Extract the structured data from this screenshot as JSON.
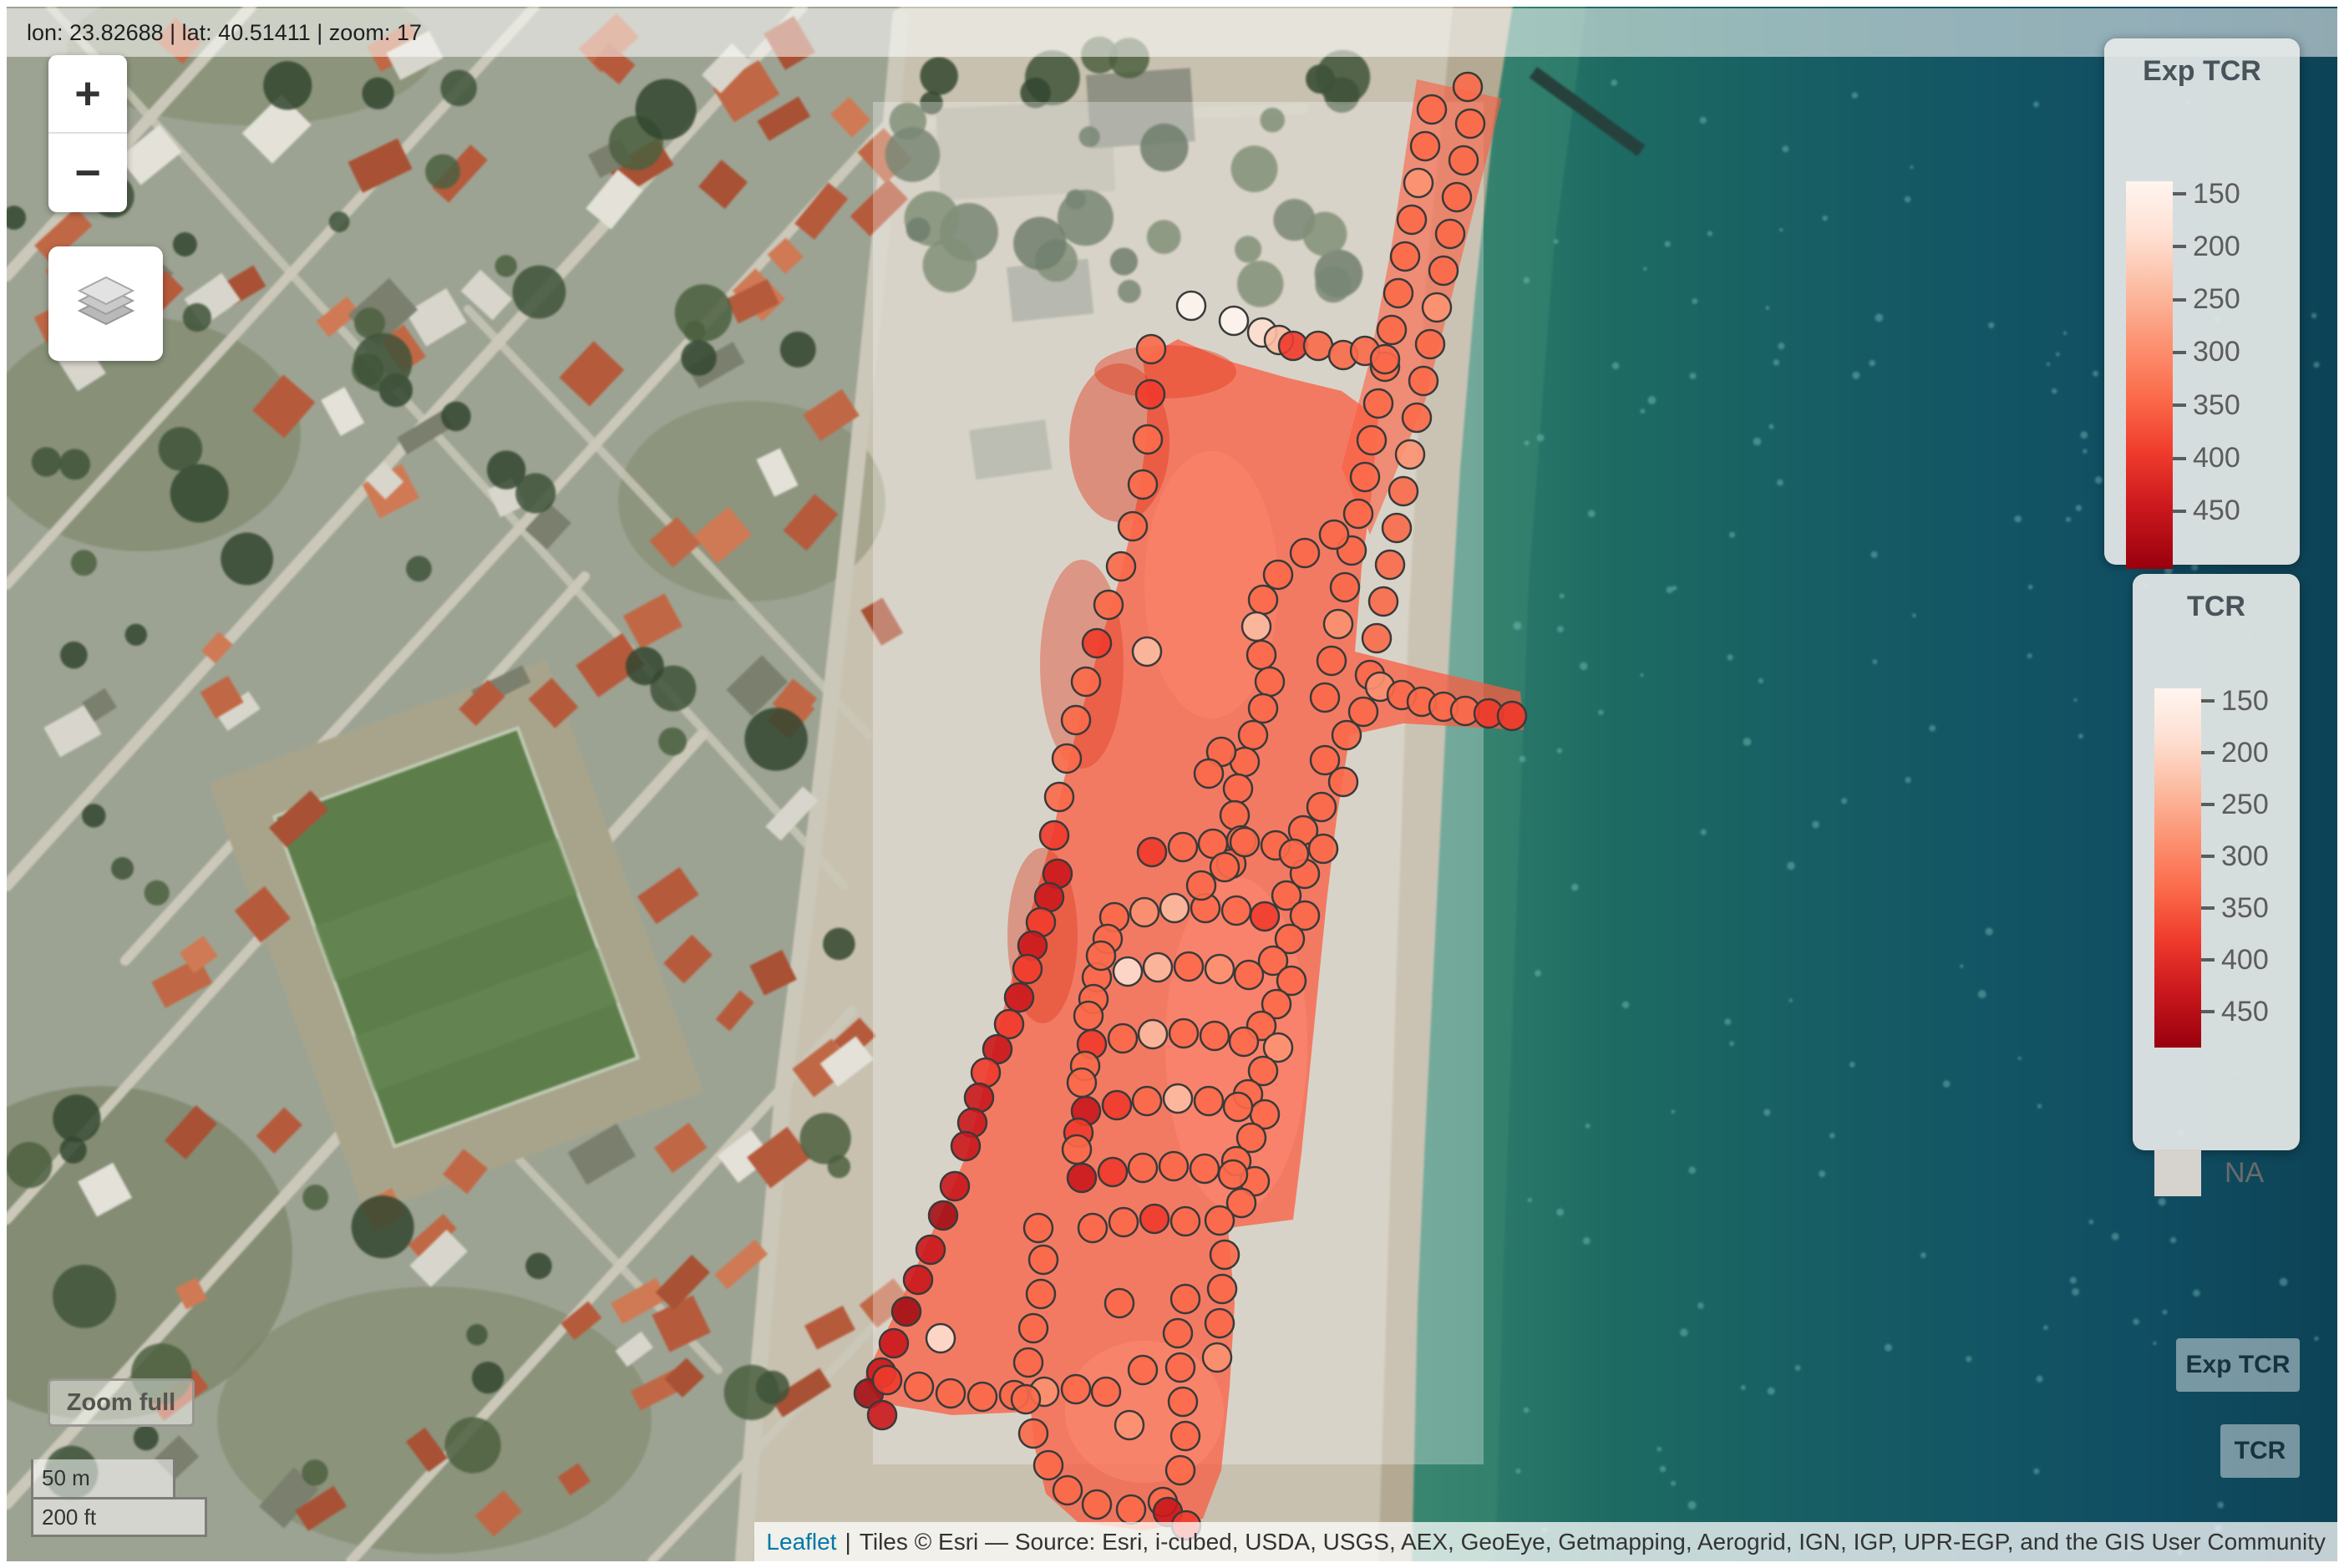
{
  "top_bar": {
    "text": "lon: 23.82688 | lat: 40.51411 | zoom: 17"
  },
  "controls": {
    "zoom_in": "+",
    "zoom_out": "−",
    "zoom_full": "Zoom full"
  },
  "scale_bar": {
    "metric": "50 m",
    "imperial": "200 ft"
  },
  "legends": [
    {
      "id": "exp-tcr",
      "title": "Exp TCR",
      "ticks": [
        "150",
        "200",
        "250",
        "300",
        "350",
        "400",
        "450"
      ]
    },
    {
      "id": "tcr",
      "title": "TCR",
      "ticks": [
        "150",
        "200",
        "250",
        "300",
        "350",
        "400",
        "450"
      ],
      "na_label": "NA"
    }
  ],
  "layer_buttons": [
    {
      "label": "Exp TCR"
    },
    {
      "label": "TCR"
    }
  ],
  "attribution": {
    "leaflet": "Leaflet",
    "separator": "|",
    "tiles": "Tiles © Esri — Source: Esri, i-cubed, USDA, USGS, AEX, GeoEye, Getmapping, Aerogrid, IGN, IGP, UPR-EGP, and the GIS User Community"
  },
  "map": {
    "marker_radius": 17,
    "palette": [
      "#FFF5F0",
      "#FEE0D2",
      "#FCBBA1",
      "#FC9272",
      "#FB6A4A",
      "#EF3B2C",
      "#CB181D",
      "#A50F15",
      "#99000D"
    ],
    "markers": [
      [
        1757,
        104,
        4
      ],
      [
        1760,
        148,
        4
      ],
      [
        1752,
        192,
        4
      ],
      [
        1744,
        236,
        4
      ],
      [
        1736,
        280,
        4
      ],
      [
        1728,
        324,
        4
      ],
      [
        1720,
        368,
        3
      ],
      [
        1712,
        412,
        4
      ],
      [
        1704,
        456,
        4
      ],
      [
        1696,
        500,
        4
      ],
      [
        1688,
        544,
        3
      ],
      [
        1680,
        588,
        4
      ],
      [
        1672,
        632,
        4
      ],
      [
        1664,
        676,
        4
      ],
      [
        1656,
        720,
        4
      ],
      [
        1648,
        764,
        4
      ],
      [
        1640,
        808,
        4
      ],
      [
        1632,
        852,
        4
      ],
      [
        1714,
        131,
        4
      ],
      [
        1706,
        175,
        4
      ],
      [
        1698,
        219,
        3
      ],
      [
        1690,
        263,
        4
      ],
      [
        1682,
        307,
        4
      ],
      [
        1674,
        351,
        4
      ],
      [
        1666,
        395,
        4
      ],
      [
        1658,
        439,
        4
      ],
      [
        1650,
        483,
        4
      ],
      [
        1642,
        527,
        4
      ],
      [
        1634,
        571,
        4
      ],
      [
        1626,
        615,
        4
      ],
      [
        1618,
        659,
        4
      ],
      [
        1610,
        703,
        4
      ],
      [
        1602,
        747,
        3
      ],
      [
        1594,
        791,
        4
      ],
      [
        1586,
        835,
        4
      ],
      [
        1612,
        880,
        4
      ],
      [
        1586,
        910,
        4
      ],
      [
        1608,
        936,
        4
      ],
      [
        1582,
        966,
        4
      ],
      [
        1560,
        994,
        4
      ],
      [
        1584,
        1016,
        4
      ],
      [
        1562,
        1046,
        4
      ],
      [
        1540,
        1072,
        4
      ],
      [
        1562,
        1096,
        4
      ],
      [
        1544,
        1124,
        4
      ],
      [
        1524,
        1150,
        4
      ],
      [
        1546,
        1174,
        4
      ],
      [
        1528,
        1202,
        4
      ],
      [
        1510,
        1228,
        4
      ],
      [
        1530,
        1254,
        3
      ],
      [
        1512,
        1282,
        4
      ],
      [
        1494,
        1310,
        4
      ],
      [
        1514,
        1334,
        4
      ],
      [
        1498,
        1362,
        4
      ],
      [
        1480,
        1390,
        4
      ],
      [
        1502,
        1414,
        4
      ],
      [
        1486,
        1440,
        4
      ],
      [
        1597,
        640,
        4
      ],
      [
        1562,
        662,
        4
      ],
      [
        1530,
        688,
        4
      ],
      [
        1512,
        718,
        4
      ],
      [
        1504,
        750,
        2
      ],
      [
        1510,
        784,
        4
      ],
      [
        1520,
        816,
        4
      ],
      [
        1512,
        848,
        4
      ],
      [
        1500,
        880,
        4
      ],
      [
        1490,
        912,
        4
      ],
      [
        1482,
        944,
        4
      ],
      [
        1478,
        976,
        4
      ],
      [
        1486,
        1006,
        4
      ],
      [
        1474,
        1034,
        4
      ],
      [
        1652,
        822,
        3
      ],
      [
        1678,
        832,
        4
      ],
      [
        1702,
        840,
        4
      ],
      [
        1728,
        846,
        4
      ],
      [
        1754,
        851,
        4
      ],
      [
        1782,
        854,
        5
      ],
      [
        1810,
        857,
        5
      ],
      [
        1426,
        366,
        0
      ],
      [
        1477,
        384,
        0
      ],
      [
        1511,
        398,
        1
      ],
      [
        1531,
        407,
        2
      ],
      [
        1548,
        414,
        5
      ],
      [
        1578,
        414,
        4
      ],
      [
        1608,
        425,
        4
      ],
      [
        1634,
        420,
        4
      ],
      [
        1658,
        430,
        4
      ],
      [
        1378,
        418,
        4
      ],
      [
        1377,
        472,
        5
      ],
      [
        1374,
        526,
        4
      ],
      [
        1368,
        580,
        4
      ],
      [
        1356,
        630,
        4
      ],
      [
        1342,
        678,
        4
      ],
      [
        1327,
        724,
        4
      ],
      [
        1313,
        770,
        5
      ],
      [
        1300,
        816,
        4
      ],
      [
        1288,
        862,
        4
      ],
      [
        1277,
        908,
        4
      ],
      [
        1268,
        954,
        4
      ],
      [
        1262,
        1000,
        5
      ],
      [
        1266,
        1046,
        6
      ],
      [
        1256,
        1074,
        6
      ],
      [
        1246,
        1104,
        5
      ],
      [
        1236,
        1132,
        6
      ],
      [
        1230,
        1160,
        5
      ],
      [
        1220,
        1194,
        6
      ],
      [
        1208,
        1226,
        5
      ],
      [
        1194,
        1256,
        6
      ],
      [
        1180,
        1284,
        5
      ],
      [
        1172,
        1314,
        6
      ],
      [
        1164,
        1344,
        6
      ],
      [
        1156,
        1372,
        6
      ],
      [
        1143,
        1420,
        6
      ],
      [
        1129,
        1455,
        7
      ],
      [
        1114,
        1496,
        6
      ],
      [
        1099,
        1532,
        6
      ],
      [
        1085,
        1570,
        7
      ],
      [
        1070,
        1608,
        6
      ],
      [
        1055,
        1643,
        6
      ],
      [
        1040,
        1668,
        7
      ],
      [
        1056,
        1694,
        6
      ],
      [
        1062,
        1652,
        5
      ],
      [
        1100,
        1660,
        4
      ],
      [
        1138,
        1668,
        4
      ],
      [
        1176,
        1672,
        4
      ],
      [
        1214,
        1670,
        4
      ],
      [
        1250,
        1666,
        3
      ],
      [
        1288,
        1663,
        4
      ],
      [
        1324,
        1666,
        4
      ],
      [
        1126,
        1602,
        1
      ],
      [
        1379,
        1020,
        5
      ],
      [
        1416,
        1014,
        4
      ],
      [
        1452,
        1010,
        4
      ],
      [
        1490,
        1008,
        4
      ],
      [
        1527,
        1012,
        4
      ],
      [
        1549,
        1022,
        4
      ],
      [
        1334,
        1098,
        4
      ],
      [
        1370,
        1092,
        3
      ],
      [
        1406,
        1087,
        2
      ],
      [
        1443,
        1087,
        4
      ],
      [
        1480,
        1090,
        4
      ],
      [
        1514,
        1097,
        5
      ],
      [
        1313,
        1170,
        4
      ],
      [
        1350,
        1163,
        1
      ],
      [
        1386,
        1158,
        2
      ],
      [
        1423,
        1157,
        4
      ],
      [
        1460,
        1160,
        3
      ],
      [
        1495,
        1167,
        4
      ],
      [
        1307,
        1250,
        5
      ],
      [
        1344,
        1243,
        4
      ],
      [
        1380,
        1238,
        2
      ],
      [
        1417,
        1237,
        4
      ],
      [
        1454,
        1240,
        4
      ],
      [
        1489,
        1247,
        4
      ],
      [
        1300,
        1330,
        6
      ],
      [
        1337,
        1323,
        5
      ],
      [
        1373,
        1318,
        4
      ],
      [
        1410,
        1315,
        2
      ],
      [
        1447,
        1318,
        4
      ],
      [
        1482,
        1325,
        4
      ],
      [
        1295,
        1410,
        6
      ],
      [
        1332,
        1403,
        5
      ],
      [
        1368,
        1398,
        4
      ],
      [
        1405,
        1396,
        4
      ],
      [
        1442,
        1399,
        4
      ],
      [
        1476,
        1406,
        4
      ],
      [
        1326,
        1124,
        4
      ],
      [
        1318,
        1144,
        4
      ],
      [
        1309,
        1196,
        4
      ],
      [
        1303,
        1216,
        4
      ],
      [
        1299,
        1276,
        4
      ],
      [
        1295,
        1296,
        4
      ],
      [
        1291,
        1356,
        5
      ],
      [
        1289,
        1376,
        4
      ],
      [
        1308,
        1470,
        4
      ],
      [
        1345,
        1463,
        4
      ],
      [
        1382,
        1459,
        5
      ],
      [
        1419,
        1462,
        4
      ],
      [
        1243,
        1470,
        4
      ],
      [
        1249,
        1508,
        4
      ],
      [
        1246,
        1549,
        4
      ],
      [
        1237,
        1590,
        4
      ],
      [
        1231,
        1631,
        4
      ],
      [
        1228,
        1675,
        4
      ],
      [
        1237,
        1716,
        4
      ],
      [
        1255,
        1754,
        4
      ],
      [
        1278,
        1784,
        4
      ],
      [
        1313,
        1801,
        4
      ],
      [
        1354,
        1807,
        4
      ],
      [
        1392,
        1798,
        4
      ],
      [
        1413,
        1760,
        4
      ],
      [
        1419,
        1719,
        4
      ],
      [
        1416,
        1678,
        4
      ],
      [
        1413,
        1637,
        4
      ],
      [
        1410,
        1596,
        4
      ],
      [
        1419,
        1555,
        4
      ],
      [
        1460,
        1461,
        4
      ],
      [
        1466,
        1502,
        4
      ],
      [
        1463,
        1543,
        4
      ],
      [
        1460,
        1584,
        4
      ],
      [
        1457,
        1625,
        3
      ],
      [
        1398,
        1810,
        6
      ],
      [
        1420,
        1826,
        5
      ],
      [
        1340,
        1560,
        4
      ],
      [
        1368,
        1640,
        4
      ],
      [
        1352,
        1706,
        3
      ],
      [
        1373,
        780,
        2
      ],
      [
        1462,
        900,
        4
      ],
      [
        1447,
        926,
        4
      ],
      [
        1438,
        1060,
        4
      ],
      [
        1466,
        1038,
        4
      ]
    ]
  }
}
